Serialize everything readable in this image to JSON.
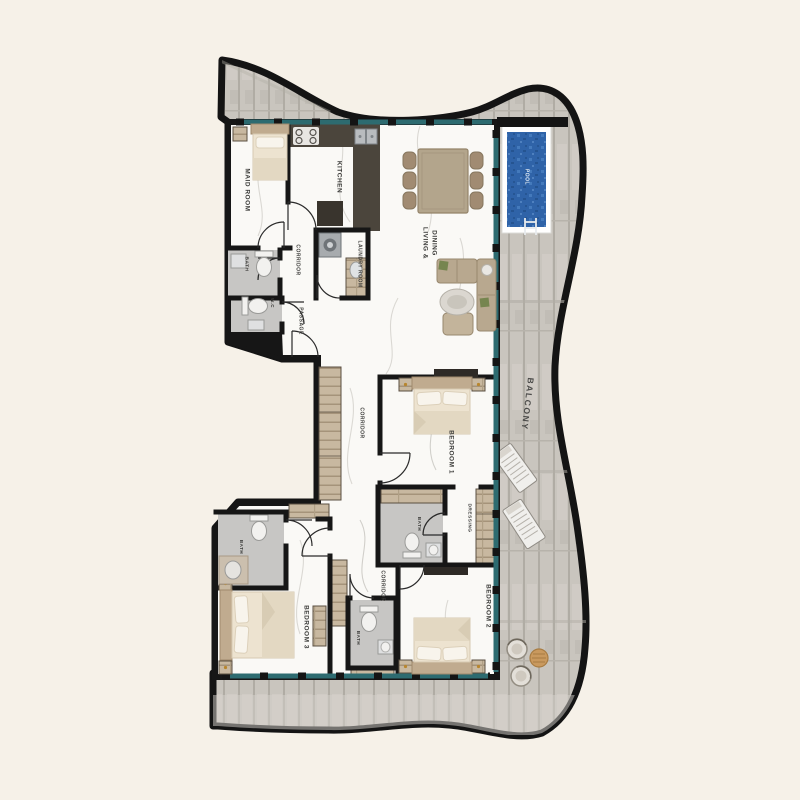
{
  "floorplan": {
    "type": "apartment-floor-plan",
    "colors": {
      "background": "#f6f1e8",
      "outline": "#141414",
      "deck": "#c9c5be",
      "interior": "#faf9f6",
      "glass": "#2d6b70",
      "pool_water": "#2f63a8",
      "wood": "#c8b8a0",
      "counter": "#4b453c",
      "bath_floor": "#c7c6c4",
      "label_text": "#3b3b39"
    },
    "labels": [
      {
        "id": "maid-room",
        "text": "MAID ROOM",
        "x": 247,
        "y": 190,
        "size": 6.5,
        "rotate": 90
      },
      {
        "id": "kitchen",
        "text": "KITCHEN",
        "x": 339,
        "y": 177,
        "size": 6.5,
        "rotate": 90
      },
      {
        "id": "bath-maid",
        "text": "BATH",
        "x": 247,
        "y": 264,
        "size": 4.8,
        "rotate": 90
      },
      {
        "id": "corridor-upper",
        "text": "CORRIDOR",
        "x": 298,
        "y": 260,
        "size": 5,
        "rotate": 90
      },
      {
        "id": "laundry-room",
        "text": "LAUNDRY ROOM",
        "x": 360,
        "y": 264,
        "size": 5,
        "rotate": 90
      },
      {
        "id": "wc",
        "text": "W.C",
        "x": 272,
        "y": 303,
        "size": 4.5,
        "rotate": 90
      },
      {
        "id": "passage",
        "text": "PASSAGE",
        "x": 301,
        "y": 321,
        "size": 5,
        "rotate": 90
      },
      {
        "id": "living-dining-line1",
        "text": "LIVING &",
        "x": 425,
        "y": 243,
        "size": 6.5,
        "rotate": 90
      },
      {
        "id": "living-dining-line2",
        "text": "DINING",
        "x": 434,
        "y": 243,
        "size": 6.5,
        "rotate": 90
      },
      {
        "id": "pool",
        "text": "POOL",
        "x": 527,
        "y": 177,
        "size": 5,
        "rotate": 90,
        "color": "#e9f1f9"
      },
      {
        "id": "balcony",
        "text": "BALCONY",
        "x": 527,
        "y": 404,
        "size": 8.5,
        "rotate": 97,
        "color": "#4a4a48",
        "spacing": 1.6
      },
      {
        "id": "corridor-mid",
        "text": "CORRIDOR",
        "x": 362,
        "y": 423,
        "size": 5,
        "rotate": 90
      },
      {
        "id": "bedroom-1",
        "text": "BEDROOM 1",
        "x": 451,
        "y": 452,
        "size": 6.5,
        "rotate": 90
      },
      {
        "id": "dressing",
        "text": "DRESSING",
        "x": 470,
        "y": 518,
        "size": 4.8,
        "rotate": 90
      },
      {
        "id": "bath-bedroom1",
        "text": "BATH",
        "x": 419,
        "y": 524,
        "size": 4.5,
        "rotate": 90
      },
      {
        "id": "bath-left",
        "text": "BATH",
        "x": 241,
        "y": 547,
        "size": 4.5,
        "rotate": 90
      },
      {
        "id": "corridor-lower",
        "text": "CORRIDOR",
        "x": 383,
        "y": 586,
        "size": 5,
        "rotate": 90
      },
      {
        "id": "bedroom-2",
        "text": "BEDROOM 2",
        "x": 488,
        "y": 606,
        "size": 6.5,
        "rotate": 90
      },
      {
        "id": "bedroom-3",
        "text": "BEDROOM 3",
        "x": 306,
        "y": 627,
        "size": 6.5,
        "rotate": 90
      },
      {
        "id": "bath-middle",
        "text": "BATH",
        "x": 358,
        "y": 638,
        "size": 4.5,
        "rotate": 90
      }
    ]
  }
}
